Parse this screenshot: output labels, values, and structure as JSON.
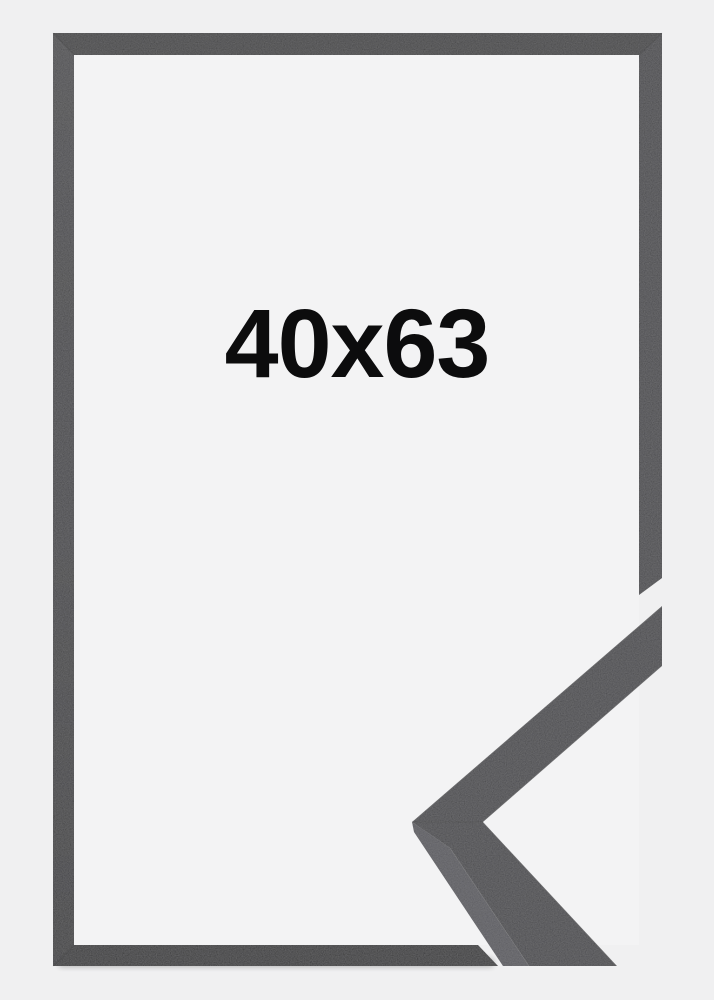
{
  "page": {
    "type": "product-photo",
    "background_color": "#f0f0f1"
  },
  "frame": {
    "size_label": "40x63",
    "label_color": "#0c0c0d",
    "opening_color": "#f3f3f4",
    "color_top": "#2d2d2f",
    "color_left": "#353537",
    "color_right": "#38383a",
    "color_bottom": "#1e1e1f"
  },
  "corner_detail": {
    "description": "moulding-profile-corner-sample",
    "face_color": "#39393b",
    "side_color": "#4e4e52"
  }
}
